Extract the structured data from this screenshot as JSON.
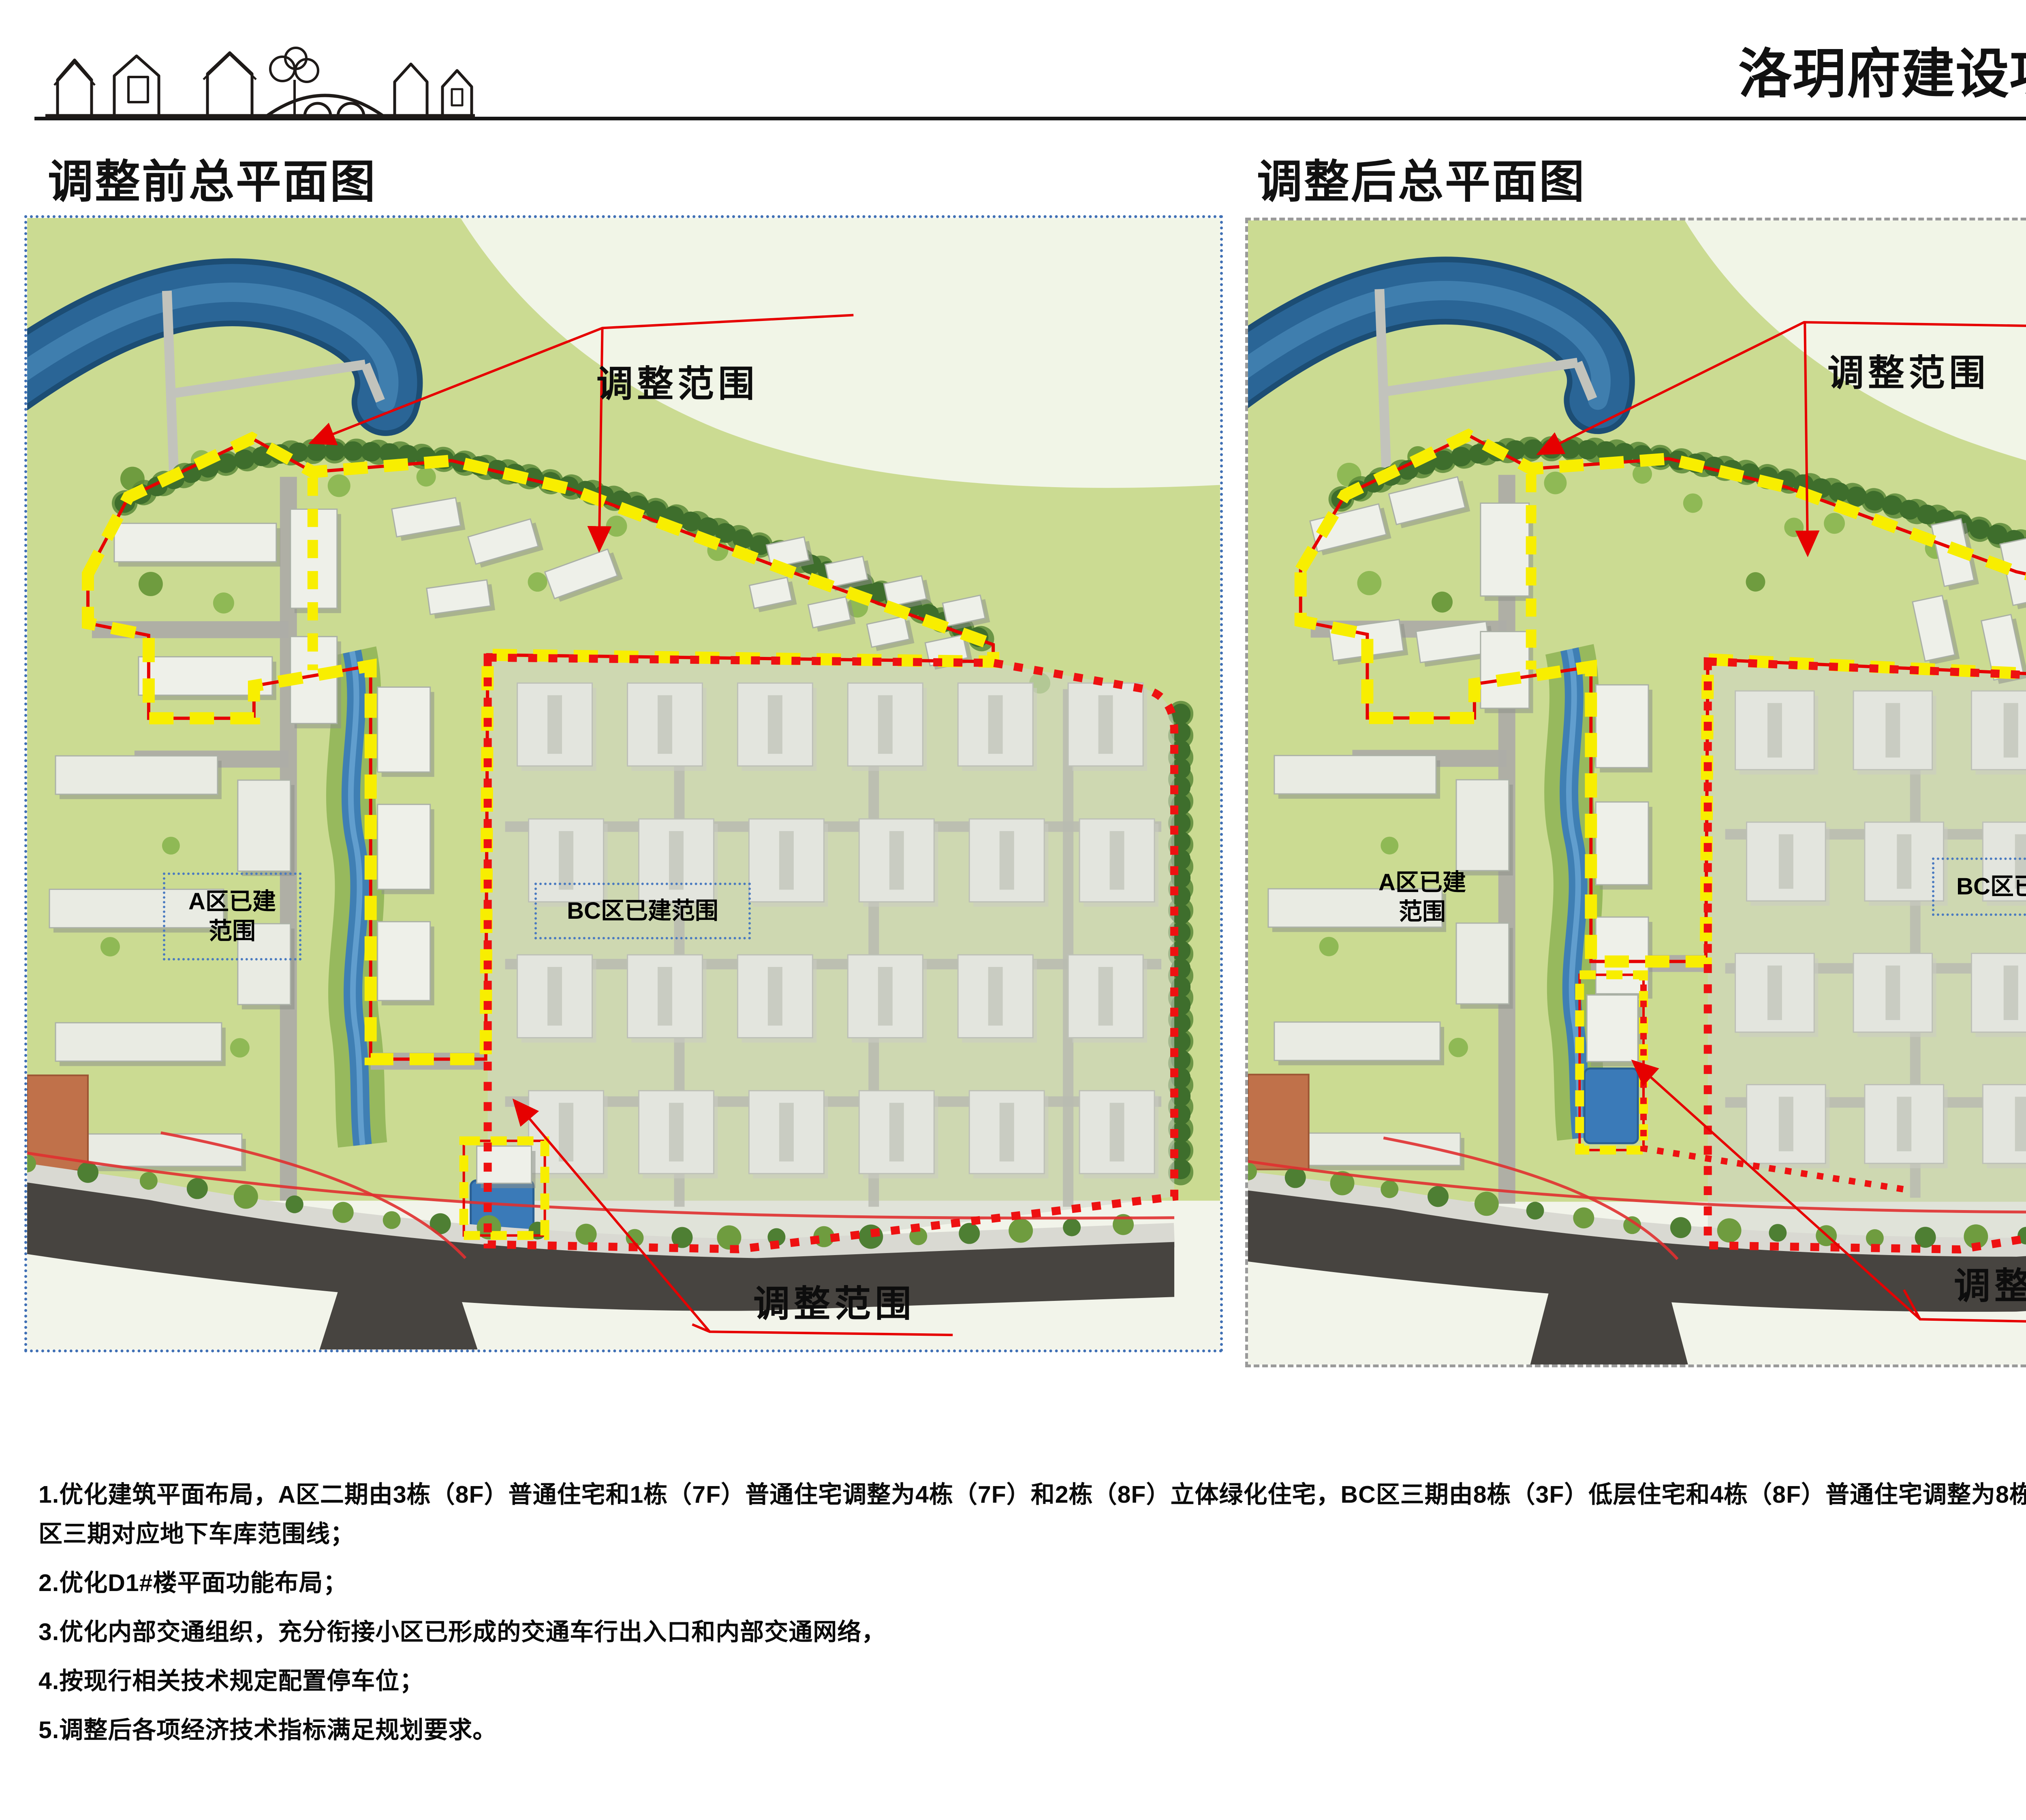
{
  "page": {
    "title": "洛玥府建设项目方案设计调整公示"
  },
  "sections": {
    "before": {
      "heading": "调整前总平面图"
    },
    "after": {
      "heading": "调整后总平面图"
    }
  },
  "map_labels": {
    "adjust_range": "调整范围",
    "a_built_line1": "A区已建",
    "a_built_line2": "范围",
    "bc_built": "BC区已建范围"
  },
  "notes": {
    "items": [
      "1.优化建筑平面布局，A区二期由3栋（8F）普通住宅和1栋（7F）普通住宅调整为4栋（7F）和2栋（8F）立体绿化住宅，BC区三期由8栋（3F）低层住宅和4栋（8F）普通住宅调整为8栋（8F）立体绿化住宅，同步优化A区二期和BC区三期对应地下车库范围线；",
      "2.优化D1#楼平面功能布局；",
      "3.优化内部交通组织，充分衔接小区已形成的交通车行出入口和内部交通网络，",
      "4.按现行相关技术规定配置停车位；",
      "5.调整后各项经济技术指标满足规划要求。"
    ]
  },
  "colors": {
    "boundary_yellow": "#f8ee00",
    "boundary_red": "#e60000",
    "built_box_blue": "#4a7ac0",
    "river_blue": "#2a6596",
    "road_dark": "#474440",
    "grass_green": "#cbdb92"
  }
}
